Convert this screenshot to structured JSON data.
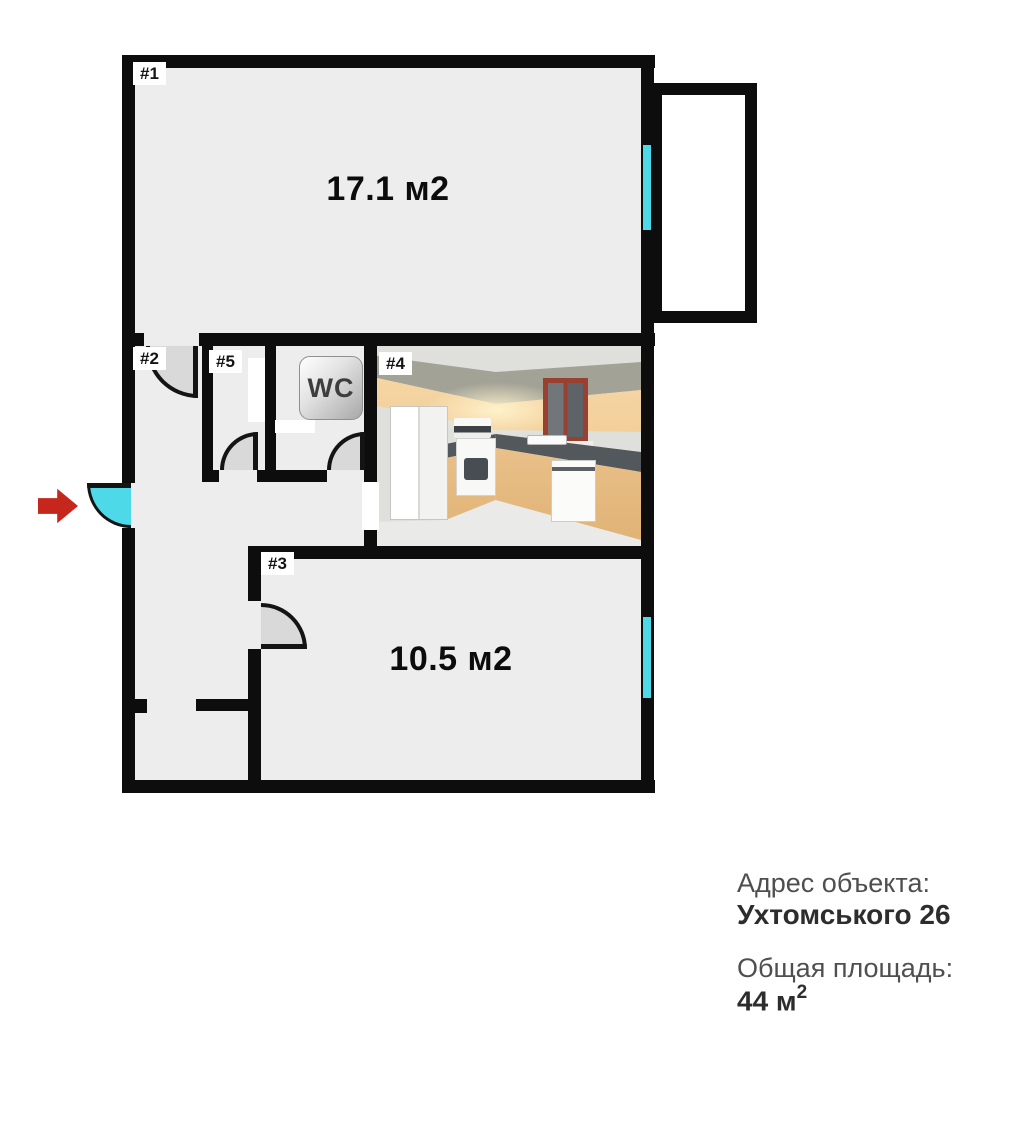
{
  "theme": {
    "wall": "#0d0d0d",
    "floor": "#ededed",
    "cyan": "#4ed9e9",
    "red": "#c5271c",
    "door": "#d9d9d9"
  },
  "plan": {
    "rooms": [
      {
        "id": "#1",
        "area": "17.1 м2"
      },
      {
        "id": "#2",
        "area": ""
      },
      {
        "id": "#3",
        "area": "10.5 м2"
      },
      {
        "id": "#4",
        "area": ""
      },
      {
        "id": "#5",
        "area": ""
      }
    ],
    "wc_label": "WC"
  },
  "info": {
    "address_label": "Адрес объекта:",
    "address_value": "Ухтомського 26",
    "total_area_label": "Общая площадь:",
    "total_area_value": "44 м",
    "total_area_sup": "2"
  }
}
